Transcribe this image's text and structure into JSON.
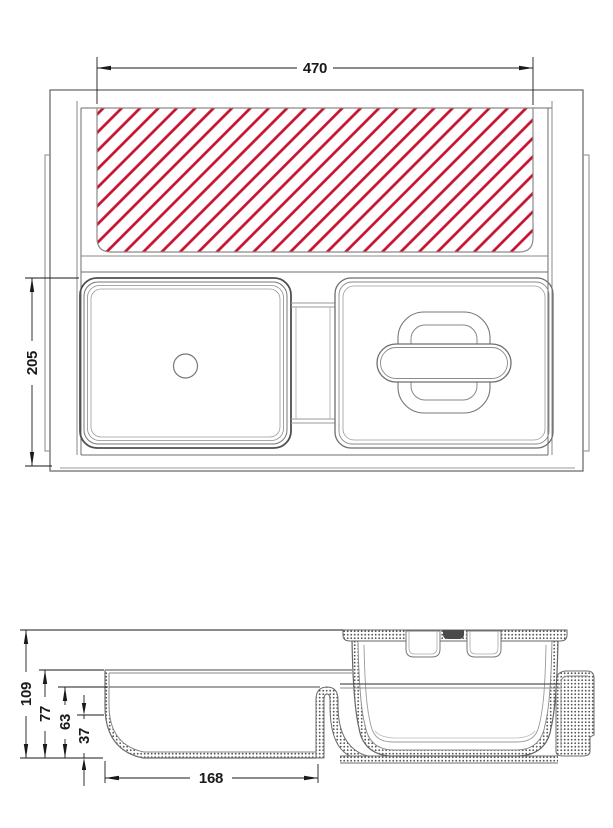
{
  "page": {
    "description": "Technical dimension drawing of a drawer organiser insert with anti-slip mat, tray lid and deep bin: plan view (top) and sectional side view (bottom)"
  },
  "colors": {
    "hatch_red": "#c8102e",
    "line_gray": "#6e6e6e",
    "dimension_black": "#1a1a1a",
    "background": "#ffffff"
  },
  "top_view": {
    "labels": {
      "width": "470",
      "depth": "205"
    }
  },
  "side_view": {
    "labels": {
      "total_height": "109",
      "rim_height": "77",
      "inner_rim_height": "63",
      "base_step_height": "37",
      "tray_length": "168"
    }
  }
}
